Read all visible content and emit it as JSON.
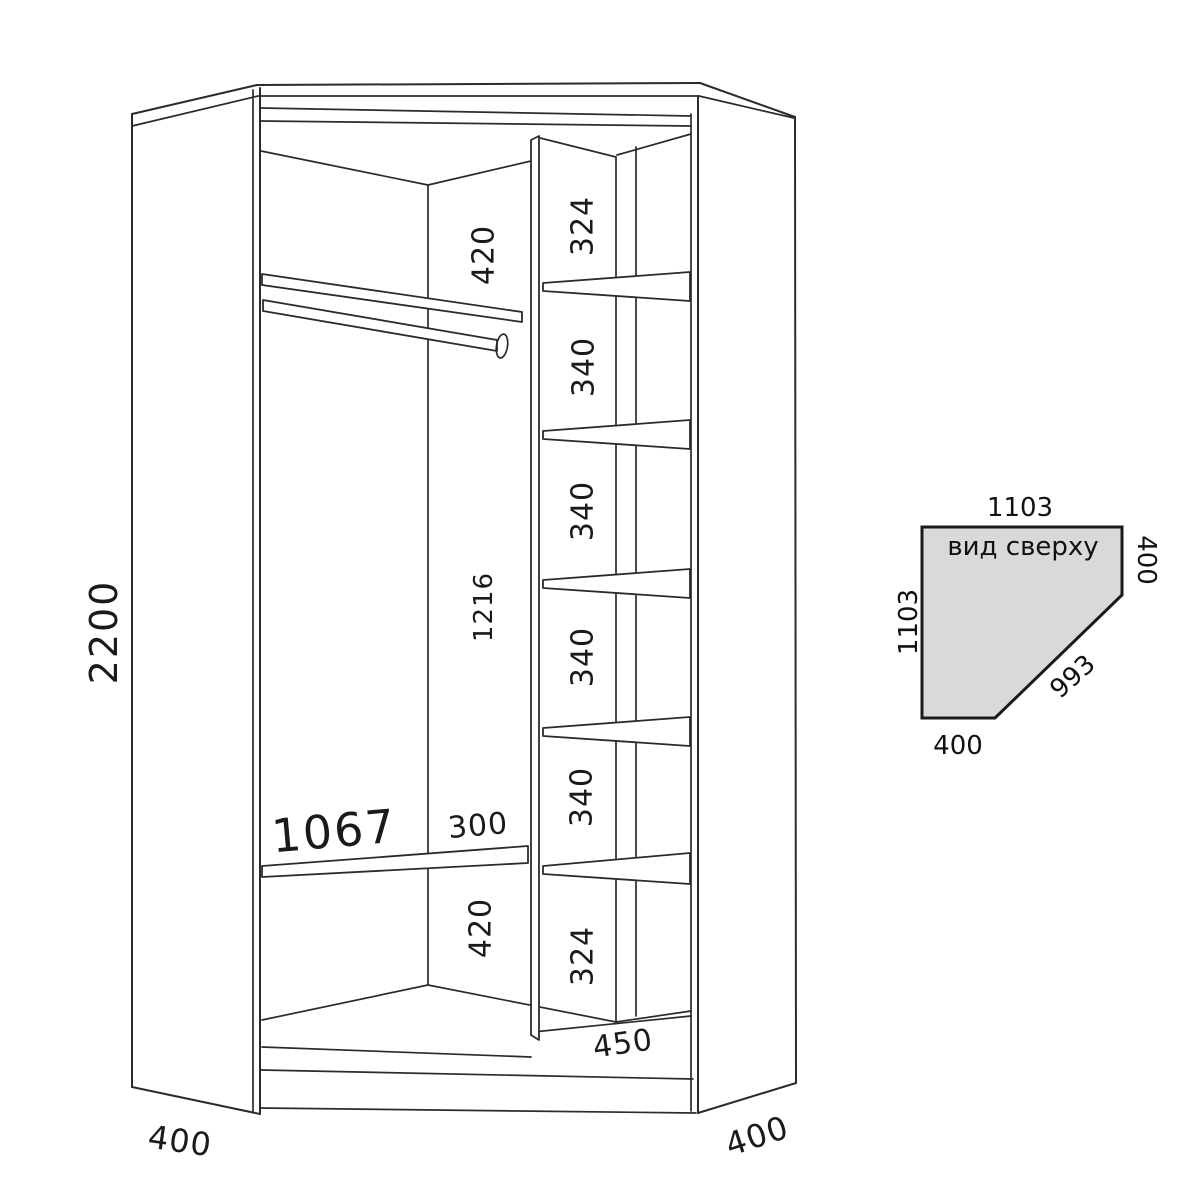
{
  "drawing": {
    "labels": {
      "overall_height": "2200",
      "top_gap": "420",
      "hang_section_height": "1216",
      "lower_shelf_width": "1067",
      "lower_shelf_depth": "300",
      "bottom_gap": "420",
      "col_gaps": [
        "324",
        "340",
        "340",
        "340",
        "340",
        "324"
      ],
      "col_width": "450",
      "left_side_depth": "400",
      "right_side_depth": "400"
    }
  },
  "top_view": {
    "title": "вид сверху",
    "top_width": "1103",
    "left_depth": "1103",
    "right_side": "400",
    "front_diagonal": "993",
    "bottom_side": "400",
    "fill": "#d9d9d9",
    "stroke": "#1a1a1a"
  },
  "colors": {
    "background": "#ffffff",
    "line": "#2b2b2b",
    "text": "#1a1a1a"
  }
}
